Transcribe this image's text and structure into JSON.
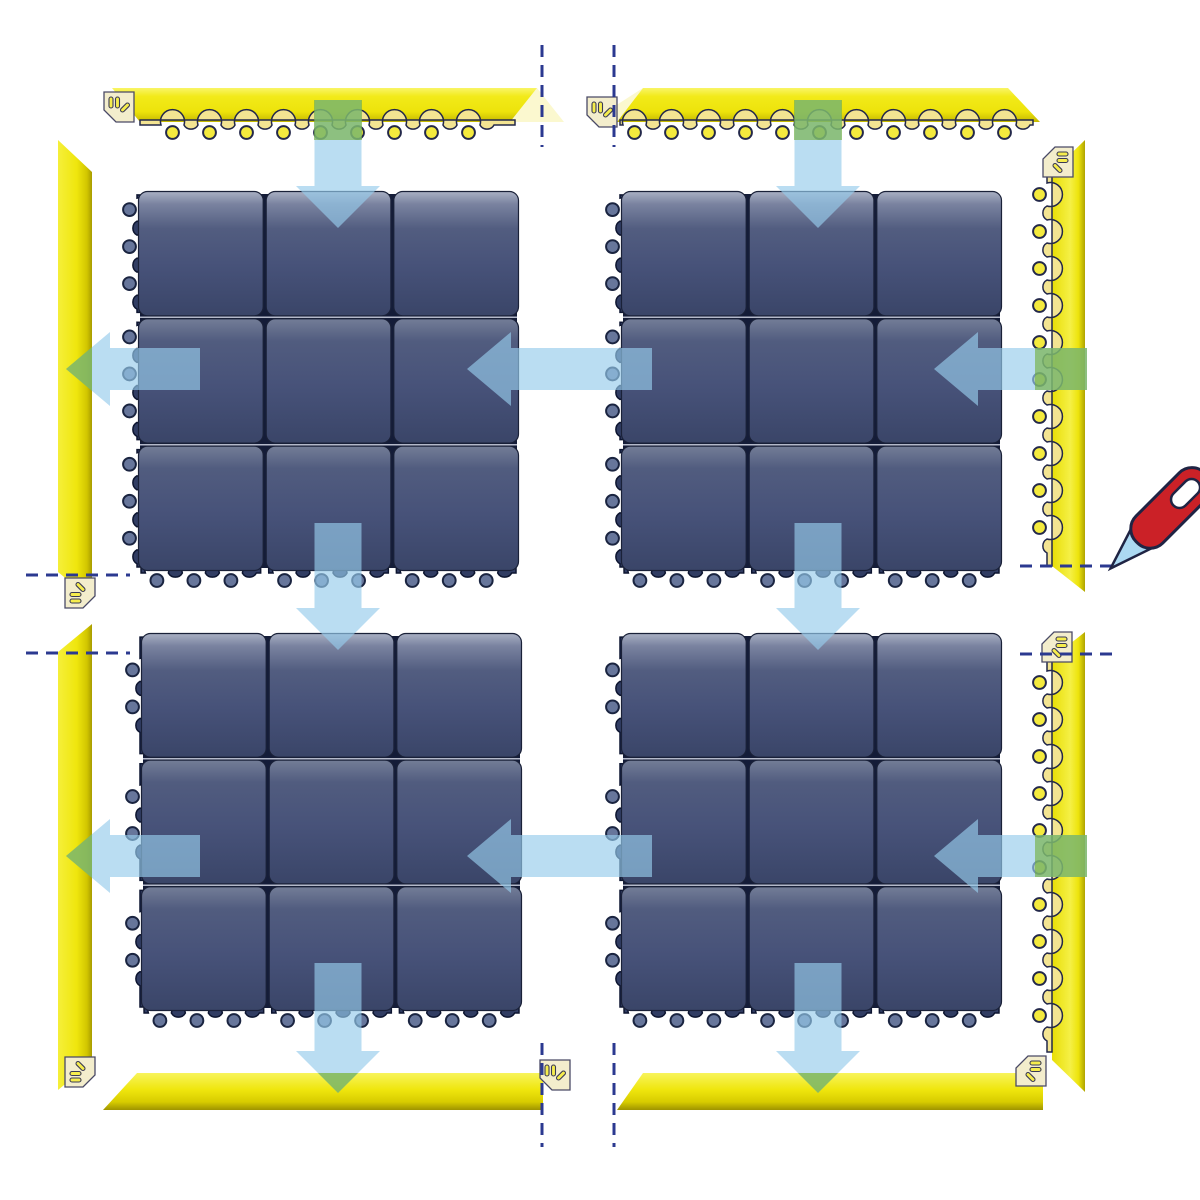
{
  "diagram": {
    "kind": "modular-floor-mat-assembly-diagram",
    "canvas": {
      "width": 1200,
      "height": 1200
    },
    "colors": {
      "background": "#ffffff",
      "mat_gap": "#141C38",
      "mat_tile_stroke": "#1A2138",
      "mat_row_line": "#C6CBDA",
      "mat_scallop_fill": "#313D63",
      "mat_scallop_stroke": "#0D1530",
      "mat_circle_fill": "#67769B",
      "mat_circle_stroke": "#1A2440",
      "ramp_scallop_fill": "#F3E492",
      "ramp_scallop_stroke": "#23284A",
      "ramp_circle_fill": "#F4EA3E",
      "ramp_circle_stroke": "#23284A",
      "ramp_fade": "#F7F2A8",
      "corner_fill": "#F3EDCC",
      "corner_stroke": "#4A4A66",
      "corner_slot_fill": "#F6ED4D",
      "corner_slot_stroke": "#3A3A55",
      "arrow_fill": "rgba(151,203,235,0.66)",
      "arrow_green_patch": "rgba(111,174,51,0.6)",
      "cut_line": "#2B3990",
      "knife_handle": "#CB2127",
      "knife_blade": "#ACD9F2",
      "knife_stroke": "#1F2444",
      "knife_slot": "#FFFFFF",
      "grad_row0": [
        "#A9B0C3",
        "#7A83A0",
        "#525D80",
        "#475279",
        "#3A4568"
      ],
      "grad_row": [
        "#737D97",
        "#515C7F",
        "#475279",
        "#3A4568"
      ],
      "grad_face_h": [
        "#F9F567",
        "#F2EA19",
        "#EDE30B",
        "#C4B800"
      ],
      "grad_face_r": [
        "#E8DE06",
        "#F5F046",
        "#EDE40C",
        "#AFA300"
      ],
      "grad_face_l": [
        "#F5EF3A",
        "#EFE60D",
        "#D2C600",
        "#A89C00"
      ],
      "grad_face_b": [
        "#F8F45C",
        "#EFE60D",
        "#D8CC00",
        "#9E9300"
      ]
    },
    "mats": [
      {
        "id": "mat-top-left",
        "x": 137,
        "y": 190,
        "w": 383,
        "h": 382,
        "rows": 3,
        "cols": 3
      },
      {
        "id": "mat-top-right",
        "x": 620,
        "y": 190,
        "w": 383,
        "h": 382,
        "rows": 3,
        "cols": 3
      },
      {
        "id": "mat-bottom-left",
        "x": 140,
        "y": 632,
        "w": 383,
        "h": 380,
        "rows": 3,
        "cols": 3
      },
      {
        "id": "mat-bottom-right",
        "x": 620,
        "y": 632,
        "w": 383,
        "h": 380,
        "rows": 3,
        "cols": 3
      }
    ],
    "ramps": [
      {
        "id": "ramp-top-left",
        "grad": "gh",
        "face": "112,88 537,88 510,122 140,122",
        "fade": "537,88 564,122 510,122",
        "scallop": {
          "x": 140,
          "y": 120,
          "len": 375,
          "rot": 0
        }
      },
      {
        "id": "ramp-top-right",
        "grad": "gh",
        "face": "643,88 1008,88 1040,122 617,122",
        "fade": "643,88 617,122 590,122",
        "scallop": {
          "x": 620,
          "y": 120,
          "len": 413,
          "rot": 0
        }
      },
      {
        "id": "ramp-right-upper",
        "grad": "gr",
        "face": "1085,140 1085,592 1052,566 1052,172",
        "scallop": {
          "x": 1052,
          "y": 170,
          "len": 396,
          "rot": 90
        }
      },
      {
        "id": "ramp-right-lower",
        "grad": "gr",
        "face": "1085,632 1085,1092 1052,1060 1052,658",
        "scallop": {
          "x": 1052,
          "y": 660,
          "len": 392,
          "rot": 90
        }
      },
      {
        "id": "ramp-left-upper",
        "grad": "gl",
        "face": "58,140 92,172 92,600 58,572"
      },
      {
        "id": "ramp-left-lower",
        "grad": "gl",
        "face": "58,652 92,624 92,1062 58,1090"
      },
      {
        "id": "ramp-bottom-left",
        "grad": "gb",
        "face": "137,1073 543,1073 543,1110 103,1110"
      },
      {
        "id": "ramp-bottom-right",
        "grad": "gb",
        "face": "643,1073 1043,1073 1043,1110 617,1110"
      }
    ],
    "corner_connectors": [
      {
        "x": 104,
        "y": 92,
        "r": 0
      },
      {
        "x": 587,
        "y": 97,
        "r": 0
      },
      {
        "x": 1041,
        "y": 145,
        "r": 90
      },
      {
        "x": 67,
        "y": 576,
        "r": 270
      },
      {
        "x": 1040,
        "y": 630,
        "r": 90
      },
      {
        "x": 540,
        "y": 1060,
        "r": 0
      },
      {
        "x": 67,
        "y": 1055,
        "r": 270
      },
      {
        "x": 1014,
        "y": 1054,
        "r": 90
      }
    ],
    "arrows": [
      {
        "dir": "down",
        "cx": 338,
        "top": 100,
        "tip": 228
      },
      {
        "dir": "down",
        "cx": 818,
        "top": 100,
        "tip": 228
      },
      {
        "dir": "down",
        "cx": 338,
        "top": 523,
        "tip": 650
      },
      {
        "dir": "down",
        "cx": 818,
        "top": 523,
        "tip": 650
      },
      {
        "dir": "down",
        "cx": 338,
        "top": 963,
        "tip": 1093
      },
      {
        "dir": "down",
        "cx": 818,
        "top": 963,
        "tip": 1093
      },
      {
        "dir": "left",
        "cy": 369,
        "tail": 200,
        "tip": 66
      },
      {
        "dir": "left",
        "cy": 369,
        "tail": 652,
        "tip": 467
      },
      {
        "dir": "left",
        "cy": 369,
        "tail": 1087,
        "tip": 934
      },
      {
        "dir": "left",
        "cy": 856,
        "tail": 200,
        "tip": 66
      },
      {
        "dir": "left",
        "cy": 856,
        "tail": 652,
        "tip": 467
      },
      {
        "dir": "left",
        "cy": 856,
        "tail": 1087,
        "tip": 934
      }
    ],
    "arrow_overlap_patches": [
      {
        "pts": "314,100 362,100 362,140 314,140"
      },
      {
        "pts": "794,100 842,100 842,140 794,140"
      },
      {
        "pts": "318,1073 358,1073 338,1093"
      },
      {
        "pts": "798,1073 838,1073 818,1093"
      },
      {
        "pts": "66,369 92,347 92,391"
      },
      {
        "pts": "66,856 92,834 92,878"
      },
      {
        "pts": "1035,348 1087,348 1087,390 1035,390"
      },
      {
        "pts": "1035,835 1087,835 1087,877 1035,877"
      }
    ],
    "cut_lines": [
      {
        "x1": 542,
        "y1": 45,
        "x2": 542,
        "y2": 147
      },
      {
        "x1": 614,
        "y1": 45,
        "x2": 614,
        "y2": 147
      },
      {
        "x1": 542,
        "y1": 1043,
        "x2": 542,
        "y2": 1147
      },
      {
        "x1": 614,
        "y1": 1043,
        "x2": 614,
        "y2": 1147
      },
      {
        "x1": 26,
        "y1": 575,
        "x2": 130,
        "y2": 575
      },
      {
        "x1": 26,
        "y1": 653,
        "x2": 130,
        "y2": 653
      },
      {
        "x1": 1020,
        "y1": 566,
        "x2": 1120,
        "y2": 566
      },
      {
        "x1": 1020,
        "y1": 654,
        "x2": 1120,
        "y2": 654
      }
    ],
    "knife": {
      "x": 1112,
      "y": 567,
      "rot": 45
    }
  }
}
